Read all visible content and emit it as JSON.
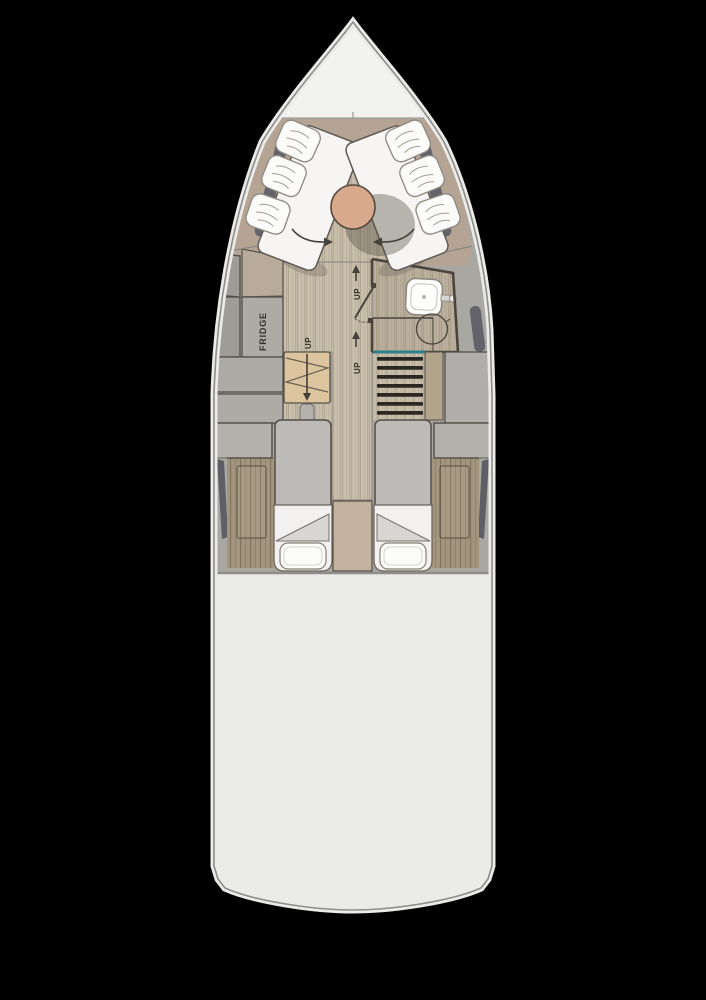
{
  "diagram": {
    "type": "yacht-interior-floor-plan",
    "orientation": "bow-at-top",
    "labels": {
      "fridge": "FRIDGE",
      "up": "UP"
    },
    "fixtures": [
      "bow-v-lounge-cushions",
      "lounge-pillows",
      "round-dining-table",
      "fridge-cabinet",
      "companionway-fold-steps",
      "wet-head-sink",
      "toilet",
      "aft-staircase",
      "port-berth",
      "starboard-berth",
      "berth-pillows"
    ],
    "colors": {
      "background": "#000000",
      "hull": "#ebebe9",
      "hull_outline": "#8f8d89",
      "foredeck": "#f2f2f0",
      "deck_gray": "#a9a7a2",
      "window_dark": "#63636b",
      "backrest_taupe": "#b5a493",
      "wood_light": "#c8beac",
      "wood_dark": "#a3957d",
      "cushion_white": "#f6f5f3",
      "table_wood": "#d9a98e",
      "cabinet_gray": "#adaba6",
      "steps_beige": "#dcc49f",
      "stair_tread": "#2b2723",
      "teal_accent": "#2e7e8e",
      "bed_gray": "#bcbbb8",
      "panel_tan": "#c2b29e",
      "wall_dark": "#4a443d"
    }
  }
}
